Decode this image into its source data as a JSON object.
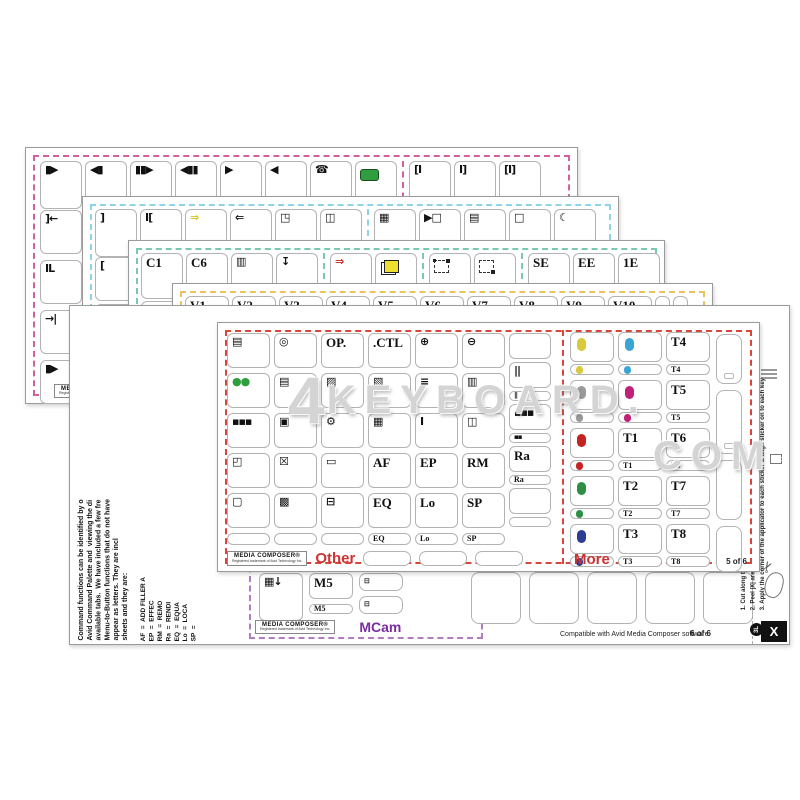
{
  "watermark": {
    "line1": "KEYBOARD.",
    "prefix": "4",
    "line2": "COM"
  },
  "brand": {
    "name": "MEDIA COMPOSER®",
    "sub": "Registered trademark of Avid Technology Inc."
  },
  "colors": {
    "sheet1_frame": "#d060a0",
    "sheet2_frame": "#8fd3e8",
    "sheet3_frame": "#79c9ac",
    "sheet4_frame": "#ecc25e",
    "sheet5_frame": "#d9453a",
    "sheet6_purple": "#b07ec0",
    "accent_red": "#cc3333",
    "mcam_purple": "#7b2d9e",
    "record_green": "#2e9e3e"
  },
  "sheet1": {
    "top_row": [
      {
        "icon": "step-forward-icon",
        "glyph": "▮▶"
      },
      {
        "icon": "step-backward-icon",
        "glyph": "◀▮"
      },
      {
        "icon": "step-forward-2-icon",
        "glyph": "▮▮▶"
      },
      {
        "icon": "step-backward-2-icon",
        "glyph": "◀▮▮"
      },
      {
        "icon": "play-icon",
        "glyph": "▶"
      },
      {
        "icon": "play-reverse-icon",
        "glyph": "◀"
      },
      {
        "icon": "phone-record-icon",
        "glyph": "☎"
      },
      {
        "icon": "record-button-icon",
        "shape": "greenrect"
      },
      {
        "icon": "trim-in-icon",
        "glyph": "[I"
      },
      {
        "icon": "trim-out-icon",
        "glyph": "I]"
      },
      {
        "icon": "trim-both-icon",
        "glyph": "[I]"
      }
    ],
    "dividers": [
      8
    ],
    "left_col": [
      {
        "icon": "mark-clip-left-icon",
        "glyph": "]←"
      },
      {
        "icon": "clip-bars-icon",
        "glyph": "IL"
      },
      {
        "icon": "go-to-mark-icon",
        "glyph": "→|"
      },
      {
        "icon": "play-from-bar-icon",
        "glyph": "▮▶"
      }
    ]
  },
  "sheet2": {
    "top_row": [
      {
        "icon": "bracket-close-icon",
        "glyph": "]"
      },
      {
        "icon": "bracket-pair-icon",
        "glyph": "I["
      },
      {
        "icon": "forward-arrow-yellow-icon",
        "glyph": "⇒",
        "color": "#d8c41c"
      },
      {
        "icon": "back-arrow-icon",
        "glyph": "⇐"
      },
      {
        "icon": "window-arrow-icon",
        "glyph": "◳"
      },
      {
        "icon": "split-window-icon",
        "glyph": "◫"
      },
      {
        "icon": "striped-panel-icon",
        "glyph": "▦"
      },
      {
        "icon": "play-window-icon",
        "glyph": "▶□"
      },
      {
        "icon": "grid-panel-icon",
        "glyph": "▤"
      },
      {
        "icon": "empty-square-icon",
        "glyph": "□"
      },
      {
        "icon": "crescent-icon",
        "glyph": "☾"
      }
    ],
    "dividers": [
      6
    ],
    "left_col": [
      {
        "icon": "bracket-open-icon",
        "glyph": "["
      },
      {
        "icon": "mark-in-green-icon",
        "glyph": "]"
      },
      {
        "icon": "mark-out-green-icon",
        "glyph": "["
      },
      {
        "icon": "i-beam-icon",
        "glyph": "I"
      }
    ]
  },
  "sheet3": {
    "top_row": [
      {
        "label": "C1"
      },
      {
        "label": "C6"
      },
      {
        "icon": "table-columns-icon",
        "glyph": "▥"
      },
      {
        "icon": "download-arrow-icon",
        "glyph": "↧"
      },
      {
        "icon": "red-arrow-icon",
        "glyph": "⇒",
        "color": "#c8201d"
      },
      {
        "icon": "yellow-pages-icon",
        "shape": "pages"
      },
      {
        "icon": "selection-dots-icon",
        "shape": "dashedbox"
      },
      {
        "icon": "selection-box-icon",
        "shape": "dashedbox2"
      },
      {
        "label": "SE"
      },
      {
        "label": "EE"
      },
      {
        "label": "1E"
      }
    ],
    "dividers": [
      4,
      6,
      8
    ],
    "left_col": [
      {
        "label": "C2"
      },
      {
        "label": "C3"
      },
      {
        "label": "C4"
      },
      {
        "label": "C5"
      }
    ]
  },
  "sheet4": {
    "top_row": [
      {
        "label": "V1"
      },
      {
        "label": "V2"
      },
      {
        "label": "V3"
      },
      {
        "label": "V4"
      },
      {
        "label": "V5"
      },
      {
        "label": "V6"
      },
      {
        "label": "V7"
      },
      {
        "label": "V8"
      },
      {
        "label": "V9"
      },
      {
        "label": "V10"
      },
      {
        "blank": true,
        "narrow": true
      },
      {
        "blank": true,
        "narrow": true
      }
    ],
    "dividers": [],
    "left_col": [
      {
        "label": "V11"
      },
      {
        "label": "V21"
      },
      {
        "label": "A7"
      },
      {
        "label": "A17"
      }
    ]
  },
  "sheet5": {
    "page": "5 of 6",
    "other_label": "Other",
    "more_label": "More",
    "other_columns": [
      [
        {
          "icon": "monitor-lines-icon",
          "glyph": "▤"
        },
        {
          "icon": "green-pills-icon",
          "glyph": "●●",
          "color": "#2e9e3e"
        },
        {
          "icon": "grid-dots-icon",
          "glyph": "▪▪▪"
        },
        {
          "icon": "two-rects-icon",
          "glyph": "◰"
        },
        {
          "icon": "outline-square-icon",
          "glyph": "▢"
        },
        {
          "small": true,
          "blank": true
        }
      ],
      [
        {
          "icon": "target-rings-icon",
          "glyph": "◎"
        },
        {
          "icon": "list-panel-icon",
          "glyph": "▤"
        },
        {
          "icon": "monitor-icon",
          "glyph": "▣"
        },
        {
          "icon": "x-box-icon",
          "glyph": "☒"
        },
        {
          "icon": "filled-panel-icon",
          "glyph": "▩"
        },
        {
          "small": true,
          "blank": true
        }
      ],
      [
        {
          "label": "OP."
        },
        {
          "icon": "page-pen-icon",
          "glyph": "▨"
        },
        {
          "icon": "gear-icon",
          "glyph": "⚙"
        },
        {
          "icon": "outline-rect-icon",
          "glyph": "▭"
        },
        {
          "icon": "eject-icon",
          "glyph": "⊟"
        },
        {
          "small": true,
          "blank": true
        }
      ],
      [
        {
          "label": ".CTL"
        },
        {
          "icon": "panel-grid-icon",
          "glyph": "▧"
        },
        {
          "icon": "clipboard-icon",
          "glyph": "▦"
        },
        {
          "label": "AF"
        },
        {
          "label": "EQ"
        },
        {
          "small": true,
          "label": "EQ"
        }
      ],
      [
        {
          "icon": "zoom-in-icon",
          "glyph": "⊕"
        },
        {
          "icon": "mixer-icon",
          "glyph": "≡"
        },
        {
          "icon": "trim-bar-icon",
          "glyph": "I"
        },
        {
          "label": "EP"
        },
        {
          "label": "Lo"
        },
        {
          "small": true,
          "label": "Lo"
        }
      ],
      [
        {
          "icon": "zoom-out-icon",
          "glyph": "⊖"
        },
        {
          "icon": "film-columns-icon",
          "glyph": "▥"
        },
        {
          "icon": "split-columns-icon",
          "glyph": "◫"
        },
        {
          "label": "RM"
        },
        {
          "label": "SP"
        },
        {
          "small": true,
          "label": "SP"
        }
      ],
      [
        {
          "blank": true
        },
        {
          "icon": "audio-sliders-icon",
          "glyph": "||"
        },
        {
          "small": true,
          "icon": "audio-sliders-icon",
          "glyph": "||"
        },
        {
          "icon": "grid-dots-icon",
          "glyph": "▪▪▪"
        },
        {
          "small": true,
          "icon": "grid-dots-icon",
          "glyph": "▪▪"
        },
        {
          "label": "Ra"
        },
        {
          "small": true,
          "label": "Ra"
        },
        {
          "blank": true
        },
        {
          "small": true,
          "blank": true
        }
      ]
    ],
    "other_bottom_blanks": 3,
    "more_columns": [
      [
        {
          "icon": "yellow-dot-icon",
          "shape": "dot",
          "color": "#d9c93c"
        },
        {
          "small": true,
          "icon": "yellow-dot-icon",
          "shape": "dot",
          "color": "#d9c93c"
        },
        {
          "icon": "gray-dot-icon",
          "shape": "dot",
          "color": "#9a9a9a"
        },
        {
          "small": true,
          "icon": "gray-dot-icon",
          "shape": "dot",
          "color": "#9a9a9a"
        },
        {
          "icon": "red-dot-icon",
          "shape": "dot",
          "color": "#c42322"
        },
        {
          "small": true,
          "icon": "red-dot-icon",
          "shape": "dot",
          "color": "#c42322"
        },
        {
          "icon": "green-dot-icon",
          "shape": "dot",
          "color": "#2d8f43"
        },
        {
          "small": true,
          "icon": "green-dot-icon",
          "shape": "dot",
          "color": "#2d8f43"
        },
        {
          "icon": "navy-dot-icon",
          "shape": "dot",
          "color": "#2c3e93"
        },
        {
          "small": true,
          "icon": "navy-dot-icon",
          "shape": "dot",
          "color": "#2c3e93"
        }
      ],
      [
        {
          "icon": "blue-dot-icon",
          "shape": "dot",
          "color": "#3aa4d4"
        },
        {
          "small": true,
          "icon": "blue-dot-icon",
          "shape": "dot",
          "color": "#3aa4d4"
        },
        {
          "icon": "magenta-dot-icon",
          "shape": "dot",
          "color": "#c02078"
        },
        {
          "small": true,
          "icon": "magenta-dot-icon",
          "shape": "dot",
          "color": "#c02078"
        },
        {
          "label": "T1"
        },
        {
          "small": true,
          "label": "T1"
        },
        {
          "label": "T2"
        },
        {
          "small": true,
          "label": "T2"
        },
        {
          "label": "T3"
        },
        {
          "small": true,
          "label": "T3"
        }
      ],
      [
        {
          "label": "T4"
        },
        {
          "small": true,
          "label": "T4"
        },
        {
          "label": "T5"
        },
        {
          "small": true,
          "label": "T5"
        },
        {
          "label": "T6"
        },
        {
          "small": true,
          "label": "T6"
        },
        {
          "label": "T7"
        },
        {
          "small": true,
          "label": "T7"
        },
        {
          "label": "T8"
        },
        {
          "small": true,
          "label": "T8"
        }
      ]
    ],
    "tall_blanks": [
      {
        "slot": true,
        "h": 48
      },
      {
        "slot": true,
        "h": 62
      },
      {
        "slot": false,
        "h": 58
      },
      {
        "slot": false,
        "h": 44
      }
    ]
  },
  "sheet6": {
    "page": "6 of 6",
    "mcam_label": "MCam",
    "compatible": "Compatible with Avid Media Composer software",
    "film_key": {
      "icon": "film-down-icon",
      "glyph": "▦↓"
    },
    "m5": {
      "label": "M5"
    },
    "m5_small": {
      "small": true,
      "label": "M5"
    },
    "film_smalls": [
      {
        "small": true,
        "icon": "film-icon",
        "glyph": "⊟"
      },
      {
        "small": true,
        "icon": "film-icon",
        "glyph": "⊟"
      }
    ],
    "blank_keys": 5,
    "paragraph": [
      "Command functions can be identified by o",
      "Avid Command Palette and  viewing the di",
      "available tabs.  We have included a few fre",
      "Menu-to-Button functions that do not have",
      "appear as letters. They are incl",
      "sheets and they are:"
    ],
    "legend": [
      {
        "key": "AF",
        "value": "ADD FILLER A"
      },
      {
        "key": "EP",
        "value": "EFFEC"
      },
      {
        "key": "RM",
        "value": "REMO"
      },
      {
        "key": "Ra",
        "value": "RENDI"
      },
      {
        "key": "EQ",
        "value": "EQUA"
      },
      {
        "key": "Lo",
        "value": "LOCA"
      },
      {
        "key": "SP",
        "value": ""
      }
    ],
    "instructions": [
      "1. Cut along the line",
      "2. Peel |X| area off applicator",
      "3. Apply the corner of the applicator to each sticker & align sticker on to each key"
    ],
    "badge": "3L",
    "cut_mark": "X"
  }
}
